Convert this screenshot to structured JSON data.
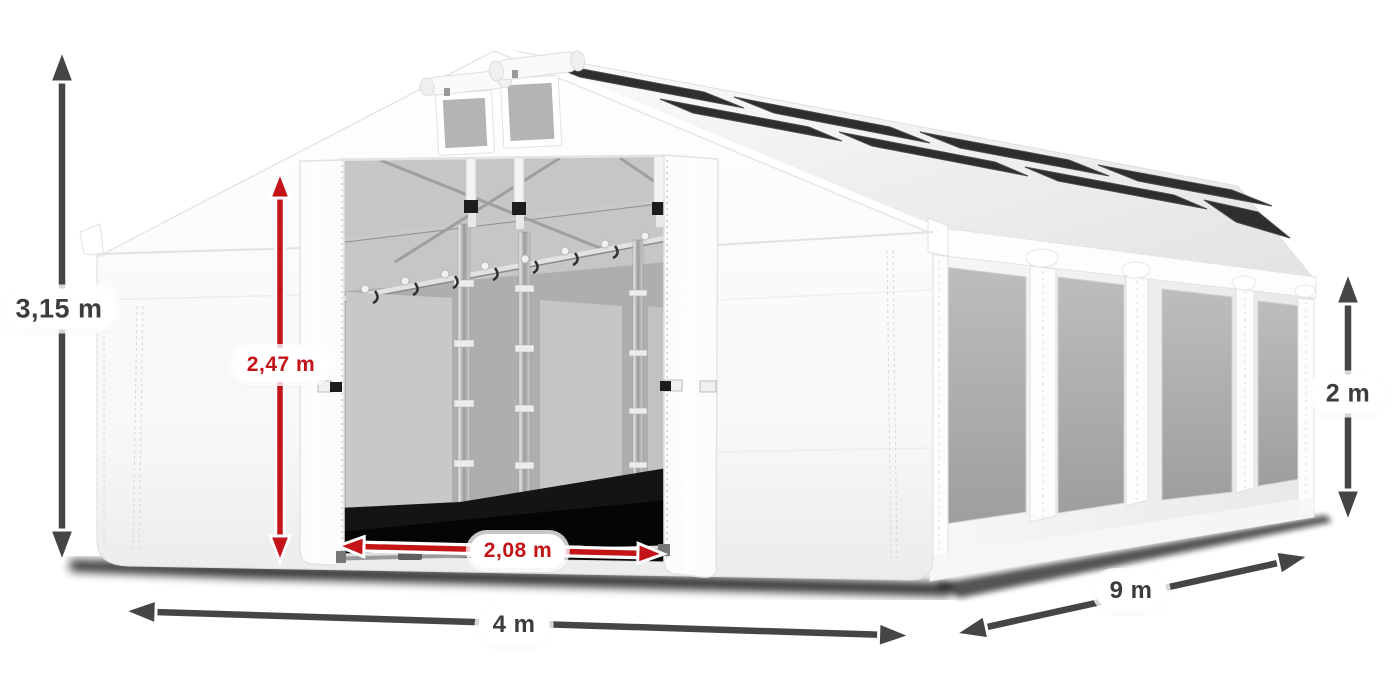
{
  "illustration": {
    "alt": "White 4 m x 9 m tent with gabled roof, open front entrance showing steel frame poles, gray mesh side windows, roof skylight strips and dimension arrows",
    "colors": {
      "dimension_dark": "#454545",
      "dimension_red": "#c31418",
      "tent_white": "#ffffff",
      "window_gray": "#ababab",
      "skylight_dark": "#2e2e2e"
    }
  },
  "measurements": {
    "total_height": {
      "label": "3,15 m",
      "style": "dark"
    },
    "entrance_height": {
      "label": "2,47 m",
      "style": "red"
    },
    "entrance_width": {
      "label": "2,08 m",
      "style": "red"
    },
    "front_width": {
      "label": "4 m",
      "style": "dark"
    },
    "side_length": {
      "label": "9 m",
      "style": "dark"
    },
    "side_wall_height": {
      "label": "2 m",
      "style": "dark"
    }
  }
}
